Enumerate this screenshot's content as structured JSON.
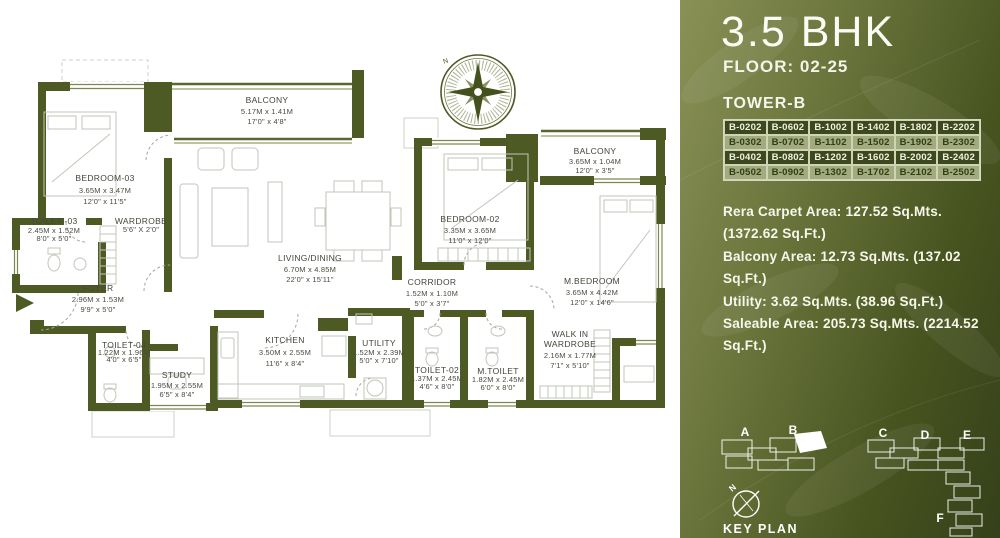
{
  "panel": {
    "title": "3.5 BHK",
    "floor_label": "FLOOR: 02-25",
    "tower_label": "TOWER-B",
    "units": [
      [
        "B-0202",
        "B-0602",
        "B-1002",
        "B-1402",
        "B-1802",
        "B-2202"
      ],
      [
        "B-0302",
        "B-0702",
        "B-1102",
        "B-1502",
        "B-1902",
        "B-2302"
      ],
      [
        "B-0402",
        "B-0802",
        "B-1202",
        "B-1602",
        "B-2002",
        "B-2402"
      ],
      [
        "B-0502",
        "B-0902",
        "B-1302",
        "B-1702",
        "B-2102",
        "B-2502"
      ]
    ],
    "areas": [
      "Rera Carpet Area: 127.52 Sq.Mts. (1372.62 Sq.Ft.)",
      "Balcony Area: 12.73 Sq.Mts. (137.02 Sq.Ft.)",
      "Utility: 3.62 Sq.Mts. (38.96 Sq.Ft.)",
      "Saleable Area: 205.73 Sq.Mts. (2214.52 Sq.Ft.)"
    ],
    "key_plan": {
      "label": "KEY PLAN",
      "north": "N",
      "buildings": [
        "A",
        "B",
        "C",
        "D",
        "E",
        "F"
      ],
      "highlighted": "B"
    },
    "colors": {
      "accent_dark": "#3c481d",
      "accent_light": "#a2ab80",
      "wall": "#4e5a24"
    }
  },
  "plan": {
    "compass_north": "N",
    "rooms": [
      {
        "name": "BALCONY",
        "metric": "5.17M x 1.41M",
        "imperial": "17'0\" x 4'8\""
      },
      {
        "name": "BEDROOM-03",
        "metric": "3.65M x 3.47M",
        "imperial": "12'0\" x 11'5\""
      },
      {
        "name": "TOILET -03",
        "metric": "2.45M x 1.52M",
        "imperial": "8'0\" x 5'0\""
      },
      {
        "name": "WARDROBE",
        "imperial": "5'6\" X 2'0\""
      },
      {
        "name": "LIVING/DINING",
        "metric": "6.70M x 4.85M",
        "imperial": "22'0\" x 15'11\""
      },
      {
        "name": "FOYER",
        "metric": "2.96M x 1.53M",
        "imperial": "9'9\" x 5'0\""
      },
      {
        "name": "TOILET-04",
        "metric": "1.22M x 1.96M",
        "imperial": "4'0\" x 6'5\""
      },
      {
        "name": "STUDY",
        "metric": "1.95M x 2.55M",
        "imperial": "6'5\" x 8'4\""
      },
      {
        "name": "KITCHEN",
        "metric": "3.50M x 2.55M",
        "imperial": "11'6\" x 8'4\""
      },
      {
        "name": "UTILITY",
        "metric": "1.52M x 2.39M",
        "imperial": "5'0\" x 7'10\""
      },
      {
        "name": "CORRIDOR",
        "metric": "1.52M x 1.10M",
        "imperial": "5'0\" x 3'7\""
      },
      {
        "name": "TOILET-02",
        "metric": "1.37M x 2.45M",
        "imperial": "4'6\" x 8'0\""
      },
      {
        "name": "M.TOILET",
        "metric": "1.82M x 2.45M",
        "imperial": "6'0\" x 8'0\""
      },
      {
        "name": "BEDROOM-02",
        "metric": "3.35M x 3.65M",
        "imperial": "11'0\" x 12'0\""
      },
      {
        "name": "BALCONY",
        "metric": "3.65M x 1.04M",
        "imperial": "12'0\" x 3'5\""
      },
      {
        "name": "M.BEDROOM",
        "metric": "3.65M x 4.42M",
        "imperial": "12'0\" x 14'6\""
      },
      {
        "name": "WALK IN",
        "name2": "WARDROBE",
        "metric": "2.16M x 1.77M",
        "imperial": "7'1\" x 5'10\""
      }
    ]
  }
}
